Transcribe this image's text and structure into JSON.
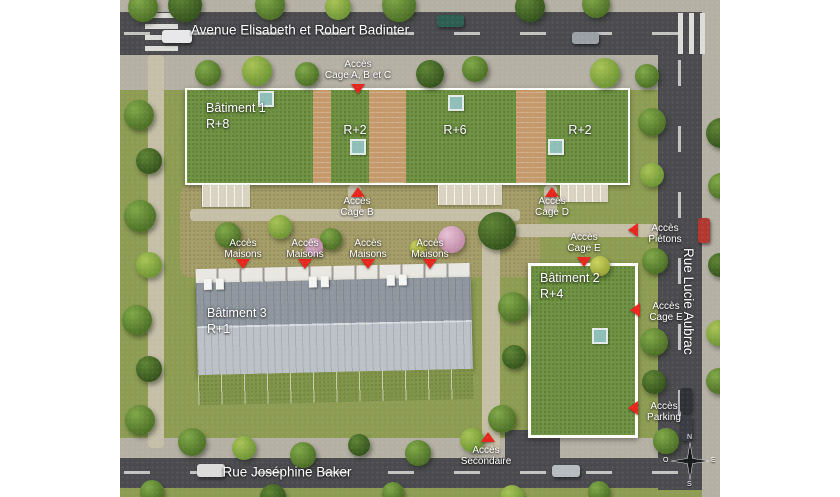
{
  "streets": {
    "top": "Avenue Elisabeth et Robert Badinter",
    "bottom": "Rue Joséphine Baker",
    "right": "Rue Lucie Aubrac"
  },
  "buildings": {
    "batiment1": {
      "name": "Bâtiment 1",
      "floors": "R+8"
    },
    "wing_r2_west": {
      "floors": "R+2"
    },
    "wing_r6": {
      "floors": "R+6"
    },
    "wing_r2_east": {
      "floors": "R+2"
    },
    "batiment2": {
      "name": "Bâtiment 2",
      "floors": "R+4"
    },
    "batiment3": {
      "name": "Bâtiment 3",
      "floors": "R+1"
    }
  },
  "access": {
    "cage_abc": {
      "line1": "Accès",
      "line2": "Cage A, B et C",
      "arrow": "down"
    },
    "cage_b": {
      "line1": "Accès",
      "line2": "Cage B",
      "arrow": "up"
    },
    "cage_d": {
      "line1": "Accès",
      "line2": "Cage D",
      "arrow": "up"
    },
    "pietons": {
      "line1": "Accès",
      "line2": "Piétons",
      "arrow": "left"
    },
    "cage_e_top": {
      "line1": "Accès",
      "line2": "Cage E",
      "arrow": "down"
    },
    "cage_e_right": {
      "line1": "Accès",
      "line2": "Cage E",
      "arrow": "left"
    },
    "maisons": {
      "line1": "Accès",
      "line2": "Maisons",
      "arrow": "down",
      "count": 4
    },
    "parking": {
      "line1": "Accès",
      "line2": "Parking",
      "arrow": "left"
    },
    "secondaire": {
      "line1": "Accès",
      "line2": "Secondaire",
      "arrow": "up"
    }
  },
  "compass": {
    "n": "N",
    "s": "S",
    "e": "E",
    "o": "O"
  },
  "colors": {
    "accent_red": "#e8261d",
    "roof_green": "#6e9241",
    "road": "#4b4b4f",
    "grass": "#8d9c52",
    "skylight_teal": "#8fbeb8"
  }
}
